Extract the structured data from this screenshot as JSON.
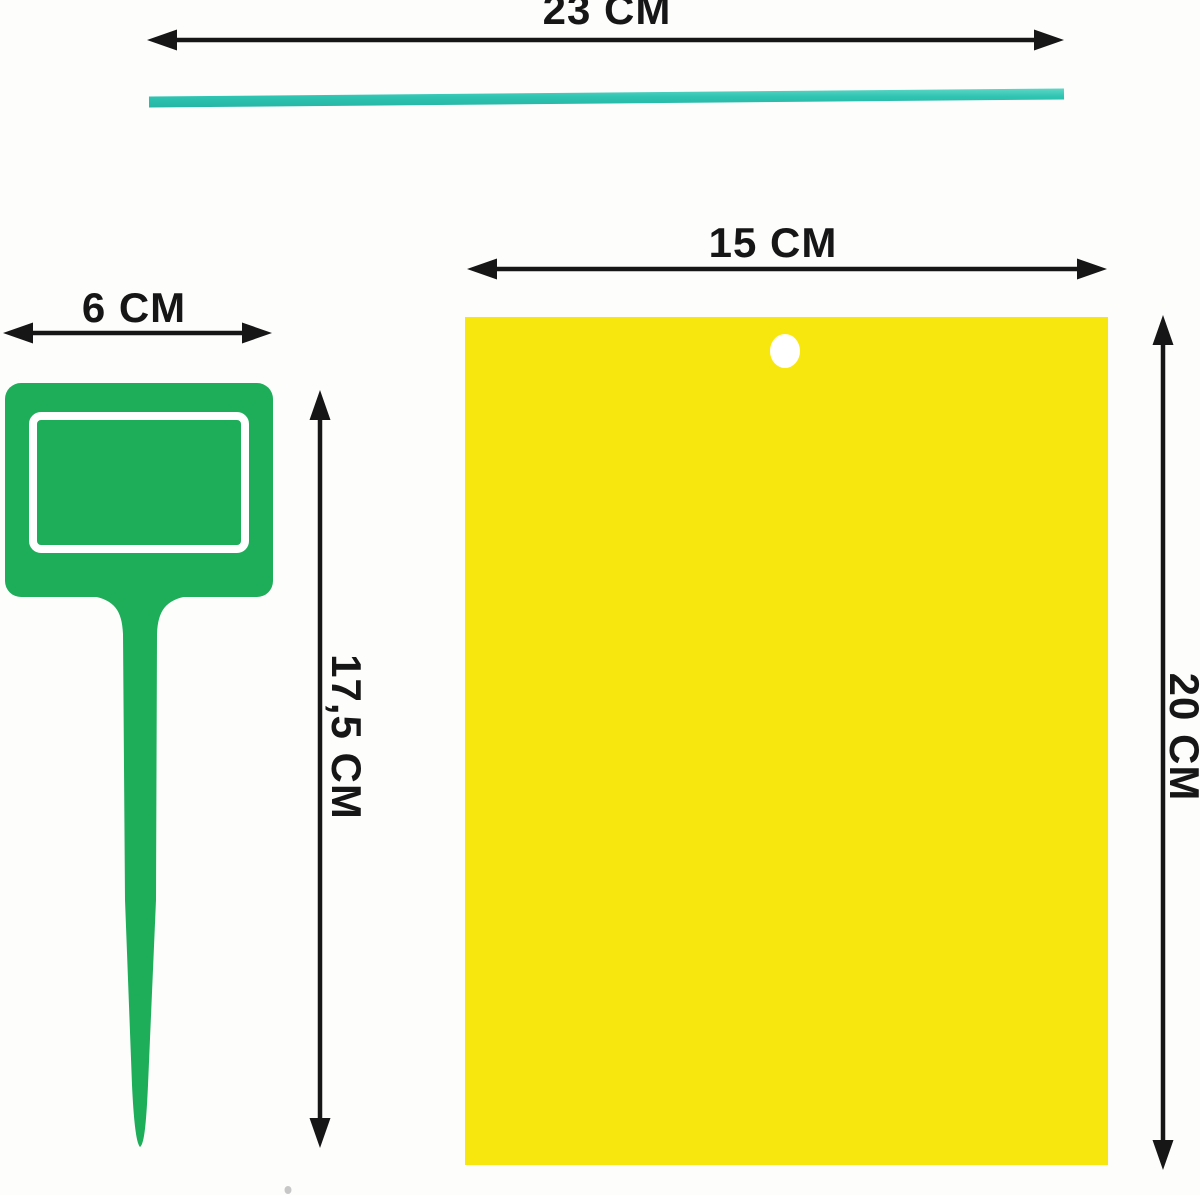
{
  "canvas": {
    "width": 1200,
    "height": 1195
  },
  "diagram": {
    "description": "product-dimensions-diagram",
    "tie": {
      "length_label": "23 CM"
    },
    "card": {
      "width_label": "15 CM",
      "height_label": "20 CM"
    },
    "stake": {
      "width_label": "6 CM",
      "height_label": "17,5 CM"
    }
  },
  "colors": {
    "bg": "#fdfdfc",
    "ink": "#161616",
    "tie-light": "#6cdccb",
    "tie-main": "#2fc3b1",
    "tie-dark": "#23b2a1",
    "stake-green": "#1ead59",
    "card-yellow": "#f8e70f",
    "white": "#ffffff"
  }
}
